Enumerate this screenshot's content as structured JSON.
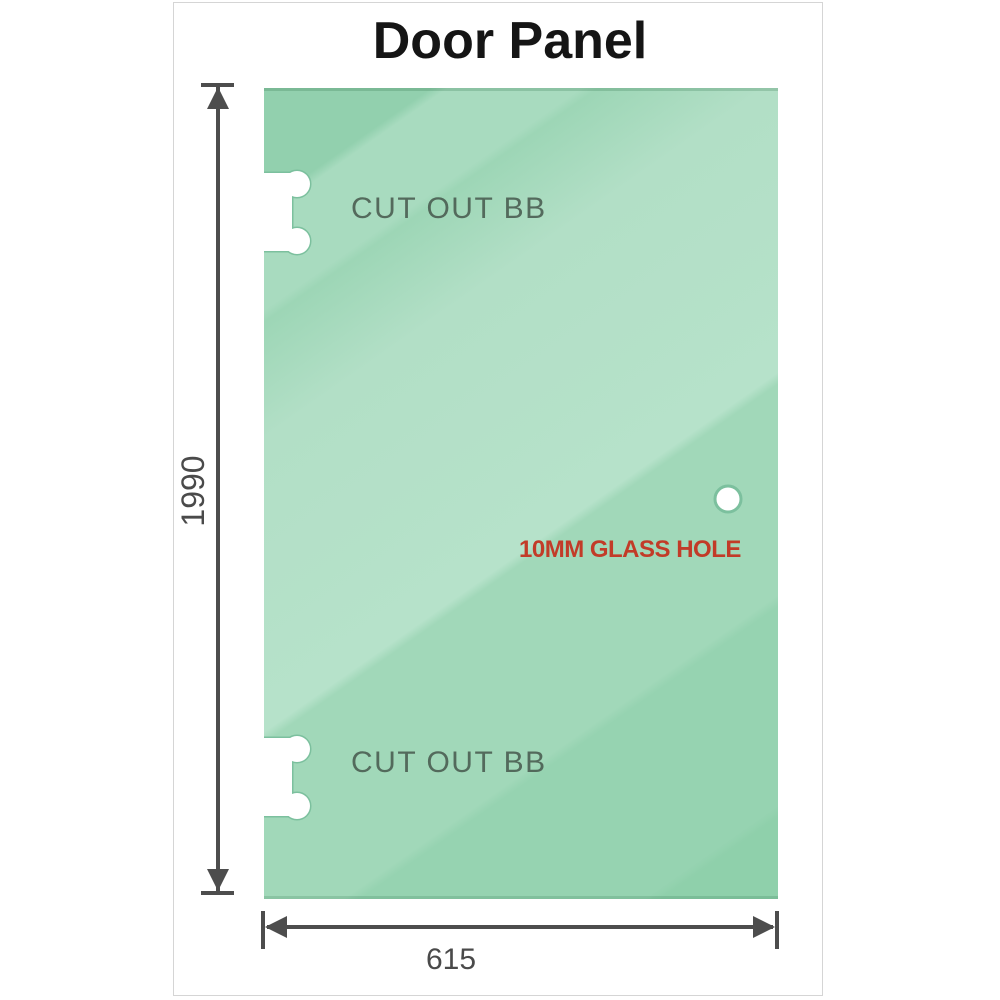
{
  "title": "Door Panel",
  "panel": {
    "cutouts": [
      {
        "label": "CUT OUT BB"
      },
      {
        "label": "CUT OUT BB"
      }
    ],
    "hole": {
      "label": "10MM GLASS HOLE",
      "label_color": "#c23b28"
    }
  },
  "dimensions": {
    "height": {
      "value": "1990"
    },
    "width": {
      "value": "615"
    }
  },
  "colors": {
    "glass_dark": "#92d0ae",
    "glass_base": "#a8dbbf",
    "glass_light": "#b6e2ca",
    "cutout_outline": "#7cc09e",
    "dimension_line": "#4d4d4d",
    "dimension_text": "#4a4a4a",
    "cutout_label": "#485a4f",
    "hole_label": "#c23b28",
    "frame_border": "#d5d5d5"
  }
}
